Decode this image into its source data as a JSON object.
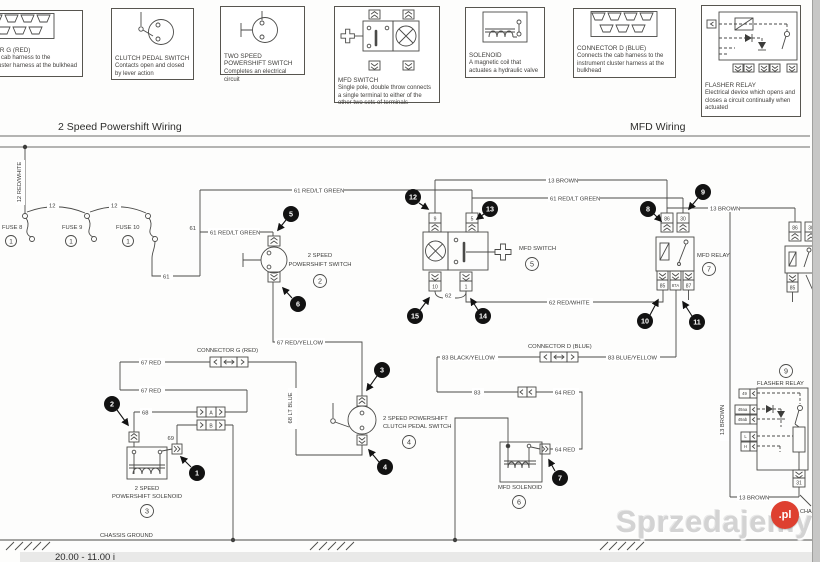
{
  "page": {
    "headers": {
      "left": "2 Speed Powershift Wiring",
      "right": "MFD Wiring"
    },
    "footer": "20.00 - 11.00 i",
    "watermark": {
      "text": "Sprzedajemy",
      "tld": ".pl"
    },
    "corner_text": "CHA",
    "ground_label": "CHASSIS GROUND"
  },
  "legend": [
    {
      "title": "CONNECTOR G (RED)",
      "desc": "Connects the cab harness to the instrument cluster harness at the bulkhead"
    },
    {
      "title": "CLUTCH PEDAL SWITCH",
      "desc": "Contacts open and closed by lever action"
    },
    {
      "title": "TWO SPEED POWERSHIFT SWITCH",
      "desc": "Completes an electrical circuit"
    },
    {
      "title": "MFD SWITCH",
      "desc": "Single pole, double throw connects a single terminal to either of the other two sets of terminals"
    },
    {
      "title": "SOLENOID",
      "desc": "A magnetic coil that actuates a hydraulic valve"
    },
    {
      "title": "CONNECTOR D (BLUE)",
      "desc": "Connects the cab harness to the instrument cluster harness at the bulkhead"
    },
    {
      "title": "FLASHER RELAY",
      "desc": "Electrical device which opens and closes a circuit continually when actuated"
    }
  ],
  "wires": {
    "w12rw": "12 RED/WHITE",
    "w12": "12",
    "w61": "61",
    "w61g": "61 RED/LT GREEN",
    "w13b": "13 BROWN",
    "w62": "62",
    "w62rw": "62 RED/WHITE",
    "w67r": "67 RED",
    "w67ry": "67 RED/YELLOW",
    "w68": "68",
    "w68lb": "68 LT BLUE",
    "w69": "69",
    "w83": "83",
    "w83blk": "83 BLACK/YELLOW",
    "w83blu": "83 BLUE/YELLOW",
    "w64r": "64 RED"
  },
  "components": {
    "fuse8": "FUSE 8",
    "fuse9": "FUSE 9",
    "fuse10": "FUSE 10",
    "conn_g": "CONNECTOR G (RED)",
    "conn_d": "CONNECTOR D (BLUE)",
    "ps2_1": "2 SPEED",
    "ps2_2": "POWERSHIFT SWITCH",
    "mfd_sw": "MFD SWITCH",
    "mfd_relay": "MFD RELAY",
    "clutch1": "2 SPEED POWERSHIFT",
    "clutch2": "CLUTCH PEDAL SWITCH",
    "sol1": "2 SPEED",
    "sol2": "POWERSHIFT SOLENOID",
    "mfd_sol": "MFD SOLENOID",
    "flasher": "FLASHER RELAY"
  },
  "terminals": {
    "t9": "9",
    "t5": "5",
    "t10": "10",
    "t1": "1",
    "t86": "86",
    "t30": "30",
    "t85": "85",
    "t87a": "87A",
    "t87": "87",
    "tA": "A",
    "tB": "B",
    "t49": "49",
    "t49aa": "49aa",
    "t49ab": "49ab",
    "tL": "L",
    "tH": "H",
    "t31": "31"
  },
  "nums": {
    "n1": "1",
    "n2": "2",
    "n3": "3",
    "n4": "4",
    "n5": "5",
    "n6": "6",
    "n7": "7",
    "n8": "8",
    "n9": "9",
    "n10": "10",
    "n11": "11",
    "n12": "12",
    "n13": "13",
    "n14": "14",
    "n15": "15"
  }
}
